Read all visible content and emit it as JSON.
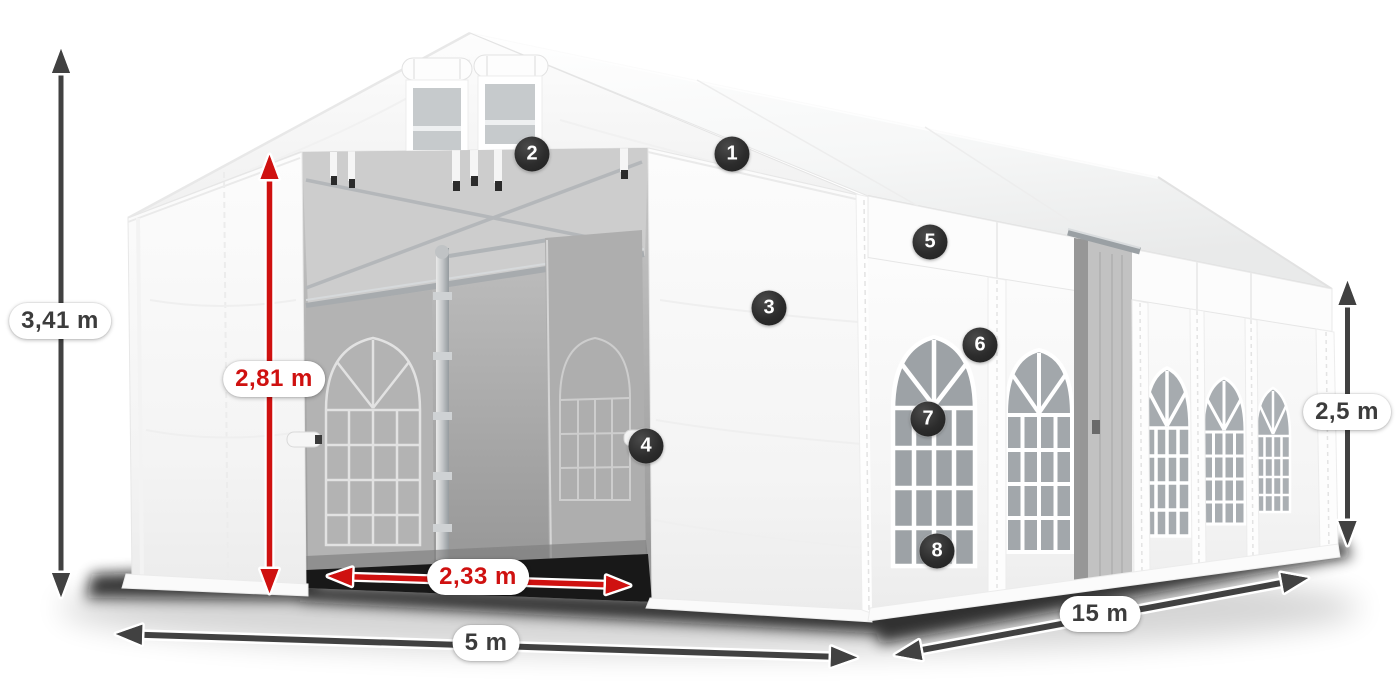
{
  "diagram": {
    "title": "party-tent-dimension-diagram",
    "colors": {
      "background": "#ffffff",
      "arrow_dark": "#414141",
      "arrow_red": "#cf1110",
      "label_text_dark": "#3c3c3c",
      "label_text_red": "#cf1110",
      "badge_background": "#2c2c2c",
      "badge_text": "#ffffff"
    },
    "dimensions": {
      "total_height": {
        "label": "3,41 m",
        "style": "dark",
        "orientation": "vertical",
        "measures": "overall tent height"
      },
      "entrance_height": {
        "label": "2,81 m",
        "style": "red",
        "orientation": "vertical",
        "measures": "entrance clear height"
      },
      "entrance_width": {
        "label": "2,33 m",
        "style": "red",
        "orientation": "horizontal",
        "measures": "entrance clear width"
      },
      "front_width": {
        "label": "5 m",
        "style": "dark",
        "orientation": "horizontal",
        "measures": "tent width"
      },
      "side_length": {
        "label": "15 m",
        "style": "dark",
        "orientation": "horizontal",
        "measures": "tent length"
      },
      "wall_height": {
        "label": "2,5 m",
        "style": "dark",
        "orientation": "vertical",
        "measures": "side wall height"
      }
    },
    "callouts": [
      {
        "number": "1"
      },
      {
        "number": "2"
      },
      {
        "number": "3"
      },
      {
        "number": "4"
      },
      {
        "number": "5"
      },
      {
        "number": "6"
      },
      {
        "number": "7"
      },
      {
        "number": "8"
      }
    ]
  }
}
